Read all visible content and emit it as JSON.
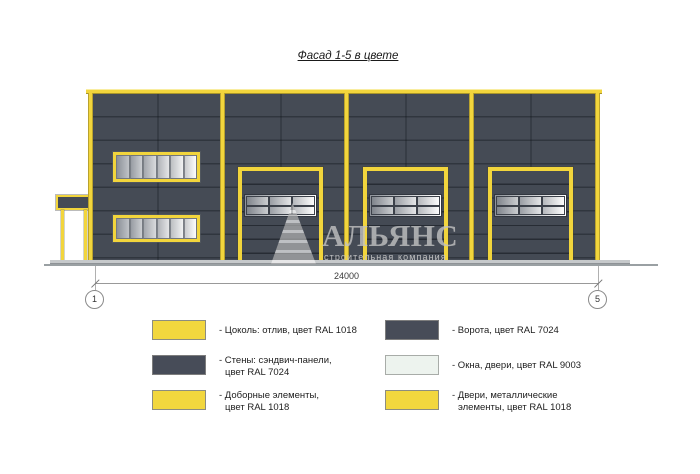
{
  "title": "Фасад 1-5 в цвете",
  "watermark": {
    "name": "АЛЬЯНС",
    "tagline": "строительная компания",
    "logo": "stepped-pyramid-logo"
  },
  "dimension": {
    "length_label": "24000",
    "axis_start": "1",
    "axis_end": "5"
  },
  "facade": {
    "gates_count": 3,
    "window_bands_count": 2,
    "colors": {
      "walls_ral_7024": "#454B55",
      "trim_ral_1018": "#F2D53C",
      "glazing_ral_9003": "#EDF3EE",
      "ground_line": "#9aa0a3"
    }
  },
  "legend": {
    "items": [
      {
        "swatch": "#F2D73E",
        "lines": [
          "- Цоколь: отлив, цвет RAL 1018"
        ]
      },
      {
        "swatch": "#474C58",
        "lines": [
          "- Стены: сэндвич-панели,",
          "цвет RAL 7024"
        ]
      },
      {
        "swatch": "#F2D73E",
        "lines": [
          "- Доборные элементы,",
          "цвет RAL 1018"
        ]
      },
      {
        "swatch": "#474C58",
        "lines": [
          "- Ворота, цвет RAL 7024"
        ]
      },
      {
        "swatch": "#EDF3EE",
        "lines": [
          "- Окна, двери, цвет RAL 9003"
        ]
      },
      {
        "swatch": "#F2D73E",
        "lines": [
          "- Двери, металлические",
          "элементы, цвет RAL 1018"
        ]
      }
    ]
  }
}
